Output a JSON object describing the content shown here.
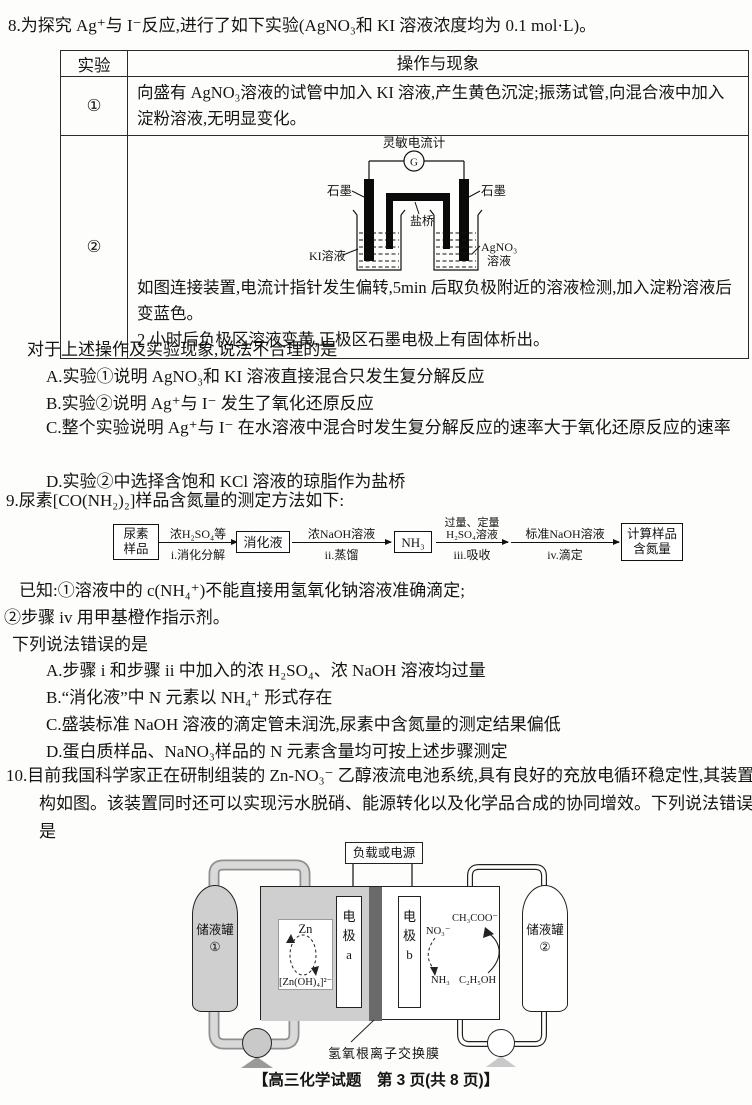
{
  "q8": {
    "stem": "8.为探究 Ag⁺与 I⁻反应,进行了如下实验(AgNO₃和 KI 溶液浓度均为 0.1 mol·L)。",
    "table": {
      "col_experiment": "实验",
      "col_operation": "操作与现象",
      "row1_label": "①",
      "row1_text": "向盛有 AgNO₃溶液的试管中加入 KI 溶液,产生黄色沉淀;振荡试管,向混合液中加入淀粉溶液,无明显变化。",
      "row2_label": "②",
      "row2_caption1": "如图连接装置,电流计指针发生偏转,5min 后取负极附近的溶液检测,加入淀粉溶液后变蓝色。",
      "row2_caption2": "2 小时后负极区溶液变黄,正极区石墨电极上有固体析出。"
    },
    "diagram": {
      "galvanometer": "灵敏电流计",
      "meter_symbol": "G",
      "graphite_left": "石墨",
      "graphite_right": "石墨",
      "salt_bridge": "盐桥",
      "ki_solution": "KI溶液",
      "agno3_line1": "AgNO₃",
      "agno3_line2": "溶液"
    },
    "prompt": "对于上述操作及实验现象,说法不合理的是",
    "options": {
      "a": "A.实验①说明 AgNO₃和 KI 溶液直接混合只发生复分解反应",
      "b": "B.实验②说明 Ag⁺与 I⁻ 发生了氧化还原反应",
      "c": "C.整个实验说明 Ag⁺与 I⁻ 在水溶液中混合时发生复分解反应的速率大于氧化还原反应的速率",
      "d": "D.实验②中选择含饱和 KCl 溶液的琼脂作为盐桥"
    }
  },
  "q9": {
    "stem": "9.尿素[CO(NH₂)₂]样品含氮量的测定方法如下:",
    "flow": {
      "box1_line1": "尿素",
      "box1_line2": "样品",
      "arrow1_top": "浓H₂SO₄等",
      "arrow1_bottom": "i.消化分解",
      "box2": "消化液",
      "arrow2_top": "浓NaOH溶液",
      "arrow2_bottom": "ii.蒸馏",
      "box3": "NH₃",
      "arrow3_top1": "过量、定量",
      "arrow3_top2": "H₂SO₄溶液",
      "arrow3_bottom": "iii.吸收",
      "arrow4_top": "标准NaOH溶液",
      "arrow4_bottom": "iv.滴定",
      "box4_line1": "计算样品",
      "box4_line2": "含氮量"
    },
    "known1": "已知:①溶液中的 c(NH₄⁺)不能直接用氢氧化钠溶液准确滴定;",
    "known2": "②步骤 iv 用甲基橙作指示剂。",
    "prompt": "下列说法错误的是",
    "options": {
      "a": "A.步骤 i 和步骤 ii 中加入的浓 H₂SO₄、浓 NaOH 溶液均过量",
      "b": "B.“消化液”中 N 元素以 NH₄⁺ 形式存在",
      "c": "C.盛装标准 NaOH 溶液的滴定管未润洗,尿素中含氮量的测定结果偏低",
      "d": "D.蛋白质样品、NaNO₃样品的 N 元素含量均可按上述步骤测定"
    }
  },
  "q10": {
    "stem": "10.目前我国科学家正在研制组装的 Zn-NO₃⁻ 乙醇液流电池系统,具有良好的充放电循环稳定性,其装置结构如图。该装置同时还可以实现污水脱硝、能源转化以及化学品合成的协同增效。下列说法错误的是",
    "diagram": {
      "power": "负载或电源",
      "tank1_line1": "储液罐",
      "tank1_line2": "①",
      "tank2_line1": "储液罐",
      "tank2_line2": "②",
      "electrode_a": "电极a",
      "electrode_b": "电极b",
      "zn": "Zn",
      "zincate": "[Zn(OH)₄]²⁻",
      "no3": "NO₃⁻",
      "ch3coo": "CH₃COO⁻",
      "nh3": "NH₃",
      "c2h5oh": "C₂H₅OH",
      "membrane": "氢氧根离子交换膜"
    }
  },
  "footer": {
    "text": "【高三化学试题　第 3 页(共 8 页)】"
  }
}
